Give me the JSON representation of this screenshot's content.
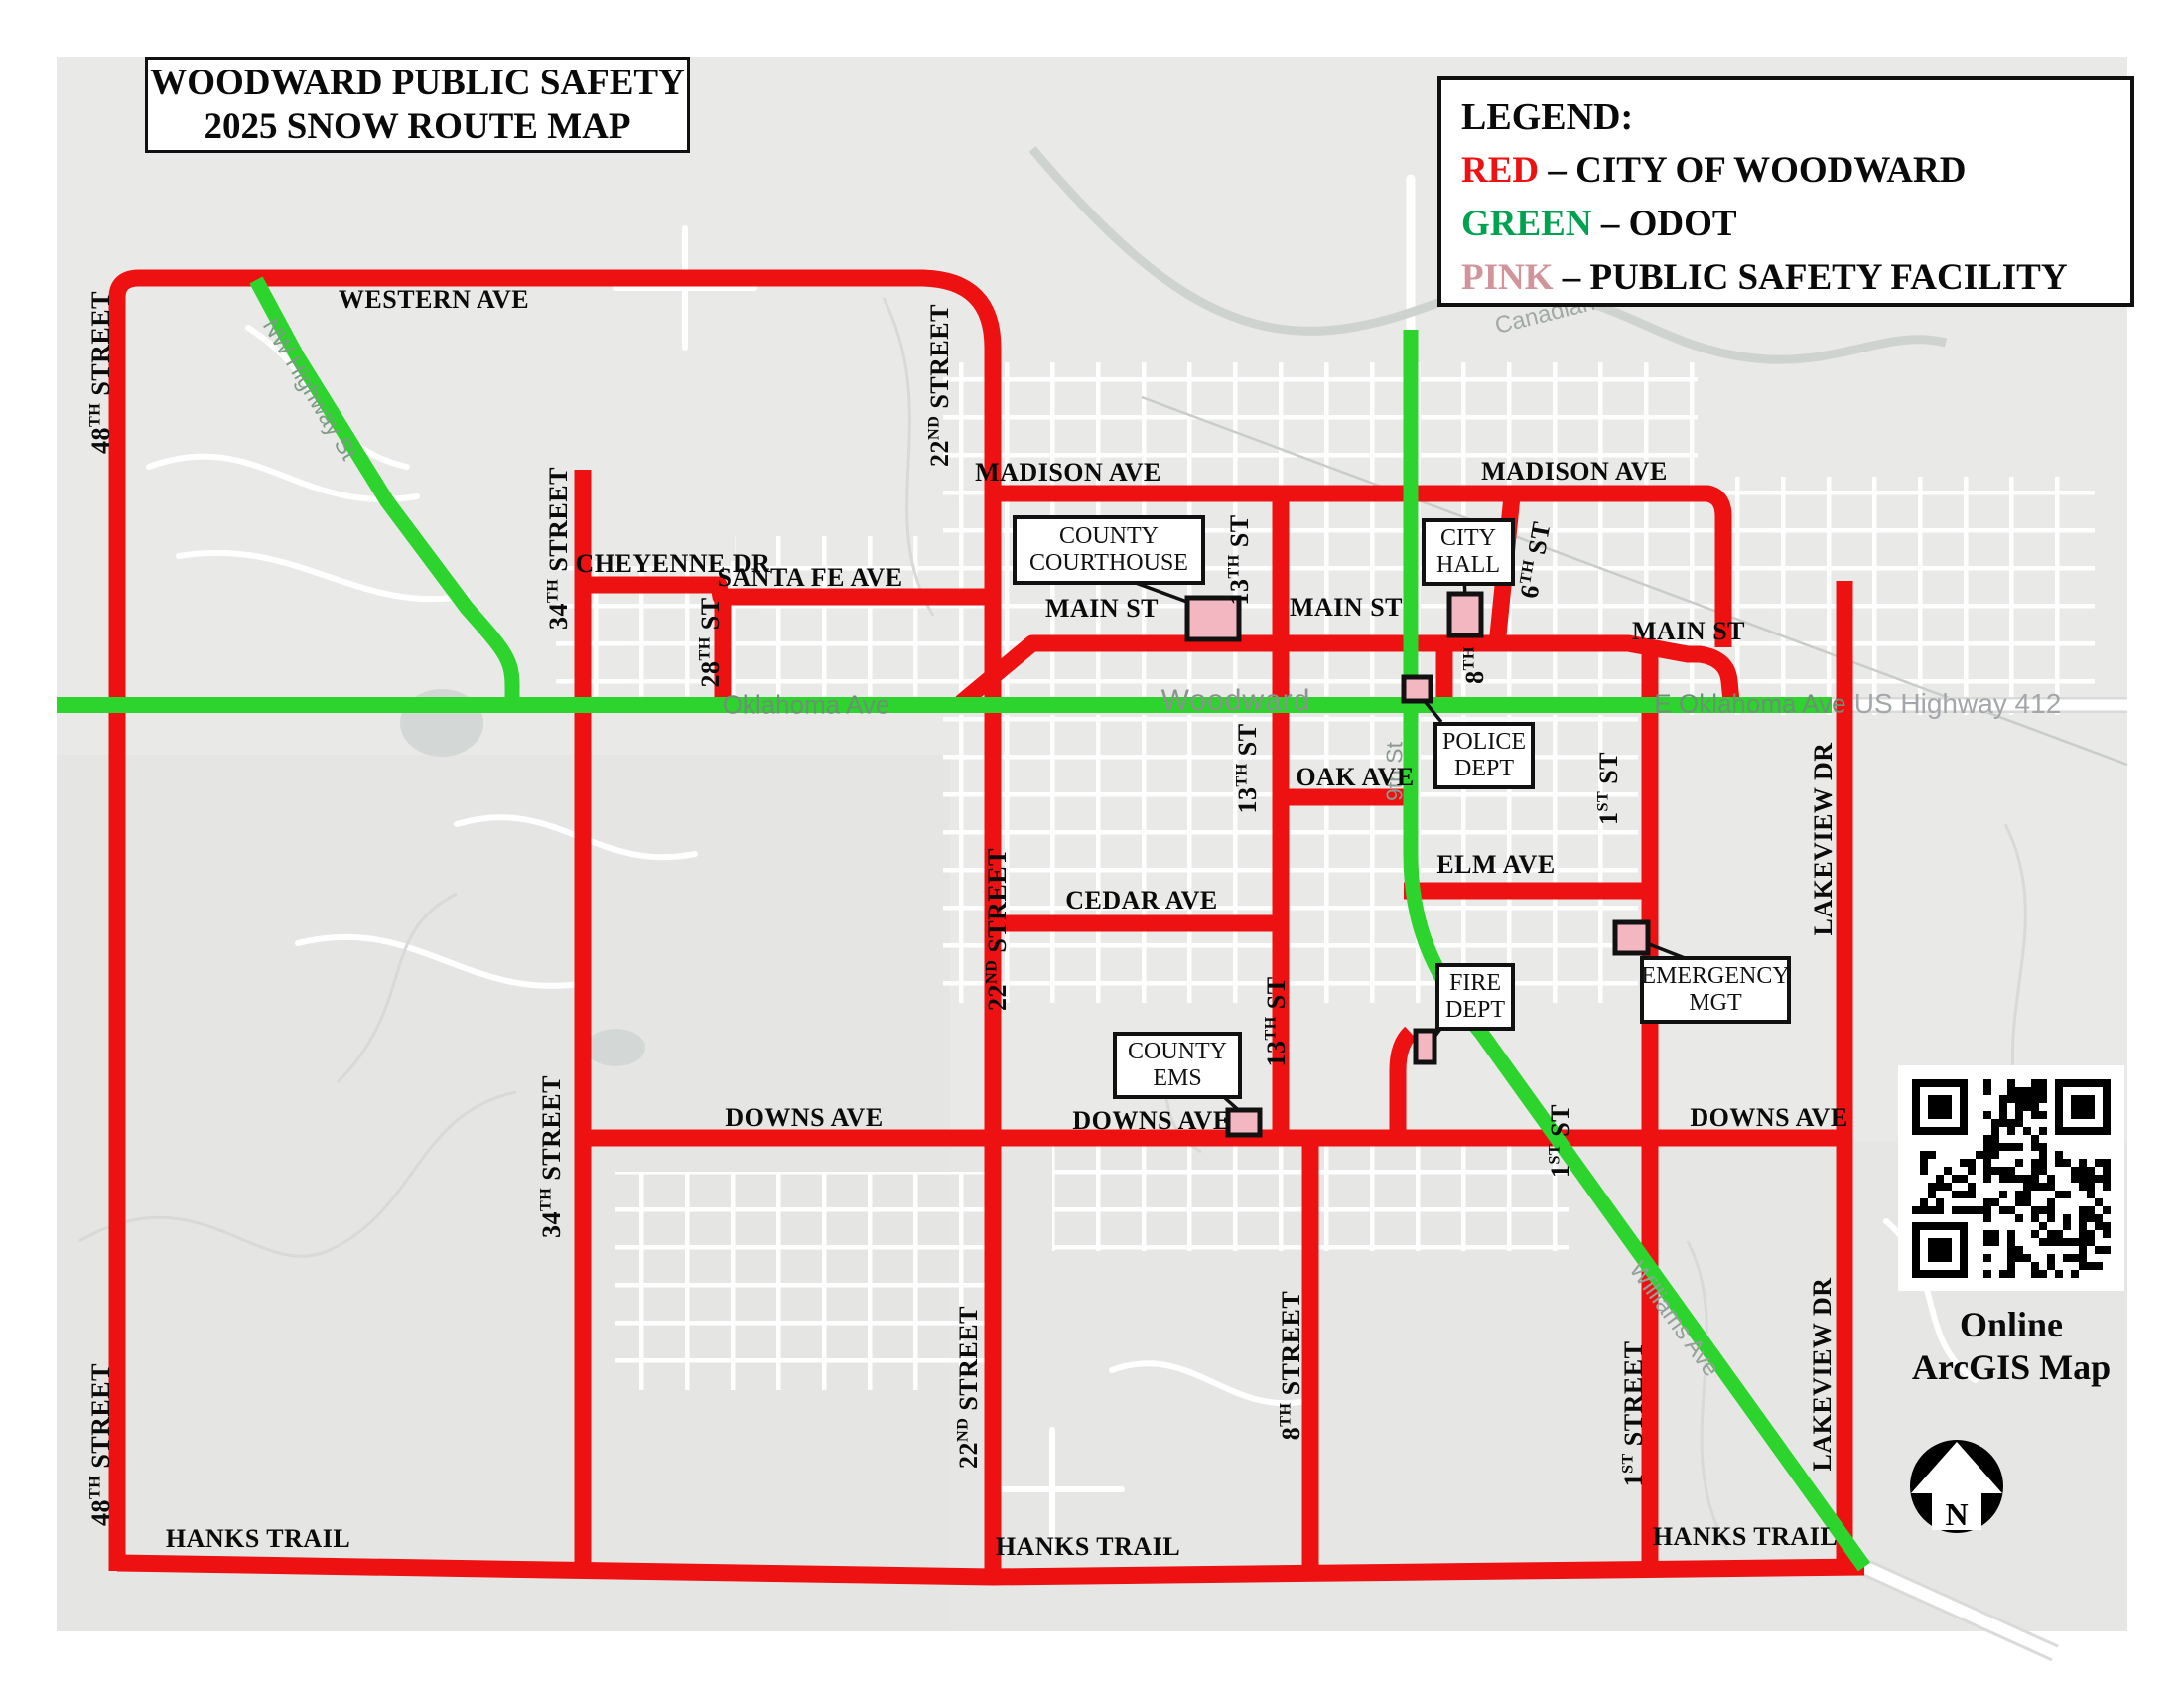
{
  "title": {
    "line1": "WOODWARD PUBLIC SAFETY",
    "line2": "2025 SNOW ROUTE MAP"
  },
  "legend": {
    "heading": "LEGEND:",
    "items": [
      {
        "key": "RED",
        "sep": " – ",
        "desc": "CITY OF WOODWARD",
        "color": "#ee1111"
      },
      {
        "key": "GREEN",
        "sep": " – ",
        "desc": "ODOT",
        "color": "#00a24f"
      },
      {
        "key": "PINK",
        "sep": " – ",
        "desc": "PUBLIC SAFETY FACILITY",
        "color": "#d0949a"
      }
    ]
  },
  "colors": {
    "route_red": "#ee1111",
    "route_green": "#2dd42d",
    "facility_pink": "#f2b7c1"
  },
  "streets": {
    "western": {
      "text": "WESTERN AVE"
    },
    "cheyenne": {
      "text": "CHEYENNE DR"
    },
    "santafe": {
      "text": "SANTA FE AVE"
    },
    "madison": {
      "text": "MADISON AVE"
    },
    "main": {
      "text": "MAIN ST"
    },
    "oak": {
      "text": "OAK AVE"
    },
    "elm": {
      "text": "ELM AVE"
    },
    "cedar": {
      "text": "CEDAR AVE"
    },
    "downs": {
      "text": "DOWNS AVE"
    },
    "hanks": {
      "text": "HANKS TRAIL"
    },
    "lakeview": {
      "text": "LAKEVIEW DR"
    },
    "s48": {
      "pre": "48",
      "sup": "TH",
      "post": " STREET"
    },
    "s34": {
      "pre": "34",
      "sup": "TH",
      "post": " STREET"
    },
    "s22": {
      "pre": "22",
      "sup": "ND",
      "post": " STREET"
    },
    "s28": {
      "pre": "28",
      "sup": "TH",
      "post": " ST"
    },
    "s13": {
      "pre": "13",
      "sup": "TH",
      "post": " ST"
    },
    "s6": {
      "pre": "6",
      "sup": "TH",
      "post": " ST"
    },
    "s8": {
      "pre": "8",
      "sup": "TH",
      "post": ""
    },
    "s8st": {
      "pre": "8",
      "sup": "TH",
      "post": " STREET"
    },
    "s1": {
      "pre": "1",
      "sup": "ST",
      "post": " ST"
    },
    "s1st": {
      "pre": "1",
      "sup": "ST",
      "post": " STREET"
    }
  },
  "facilities": {
    "courthouse": {
      "line1": "COUNTY",
      "line2": "COURTHOUSE"
    },
    "city_hall": {
      "line1": "CITY",
      "line2": "HALL"
    },
    "police": {
      "line1": "POLICE",
      "line2": "DEPT"
    },
    "fire": {
      "line1": "FIRE",
      "line2": "DEPT"
    },
    "ems": {
      "line1": "COUNTY",
      "line2": "EMS"
    },
    "emgmt": {
      "line1": "EMERGENCY",
      "line2": "MGT"
    }
  },
  "map_text": {
    "city": "Woodward",
    "oklahoma_ave": "Oklahoma Ave",
    "e_oklahoma_ave": "E Oklahoma Ave",
    "us412": "US Highway 412",
    "nw_hwy": "NW Highway St",
    "ninth_st": "9th St",
    "williams": "Williams Ave",
    "canadian": "Canadian R"
  },
  "qr": {
    "caption_line1": "Online",
    "caption_line2": "ArcGIS Map"
  },
  "north": {
    "letter": "N"
  }
}
